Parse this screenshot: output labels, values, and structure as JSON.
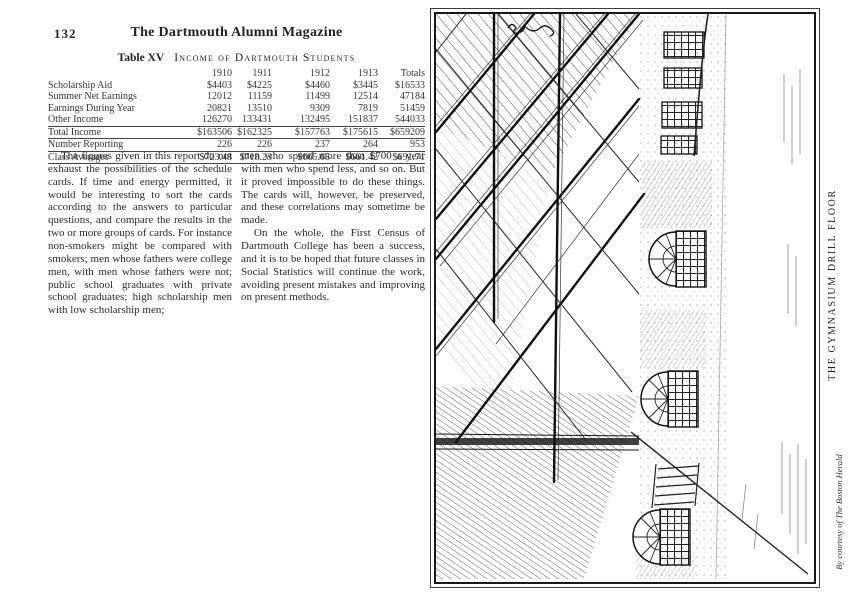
{
  "page": {
    "number": "132",
    "magazine_title": "The Dartmouth Alumni Magazine"
  },
  "table": {
    "label": "Table XV",
    "title": "Income of Dartmouth Students",
    "columns": [
      "1910",
      "1911",
      "1912",
      "1913",
      "Totals"
    ],
    "rows": [
      {
        "label": "Scholarship Aid",
        "values": [
          "$4403",
          "$4225",
          "$4460",
          "$3445",
          "$16533"
        ]
      },
      {
        "label": "Summer Net Earnings",
        "values": [
          "12012",
          "11159",
          "11499",
          "12514",
          "47184"
        ]
      },
      {
        "label": "Earnings During Year",
        "values": [
          "20821",
          "13510",
          "9309",
          "7819",
          "51459"
        ]
      },
      {
        "label": "Other Income",
        "values": [
          "126270",
          "133431",
          "132495",
          "151837",
          "544033"
        ]
      },
      {
        "label": "Total Income",
        "values": [
          "$163506",
          "$162325",
          "$157763",
          "$175615",
          "$659209"
        ]
      },
      {
        "label": "Number Reporting",
        "values": [
          "226",
          "226",
          "237",
          "264",
          "953"
        ]
      },
      {
        "label": "Class Averages",
        "values": [
          "$723.48",
          "$718.23",
          "$665.65",
          "$661.42",
          "$691.71"
        ]
      }
    ]
  },
  "article": {
    "col1_para": "The figures given in this report do not exhaust the possibilities of the schedule cards.  If time and energy permitted, it would be interesting to sort the cards according to the answers to particular questions, and compare the results in the two or more groups of cards.  For instance non-smokers might be compared with smokers; men whose fathers were college men, with men whose fathers were not; public school graduates with private school graduates; high scholarship men with low scholarship men;",
    "col2_para1": "men who spend more than $700 a year with men who spend less, and so on. But it proved impossible to do these things.  The cards will, however, be preserved, and these correlations may sometime be made.",
    "col2_para2": "On the whole, the First Census of Dartmouth College has been a success, and it is to be hoped that future classes in Social Statistics will continue the work, avoiding present mistakes and improving on present methods."
  },
  "figure": {
    "caption": "THE GYMNASIUM DRILL FLOOR",
    "credit": "By courtesy of The Boston Herald"
  }
}
